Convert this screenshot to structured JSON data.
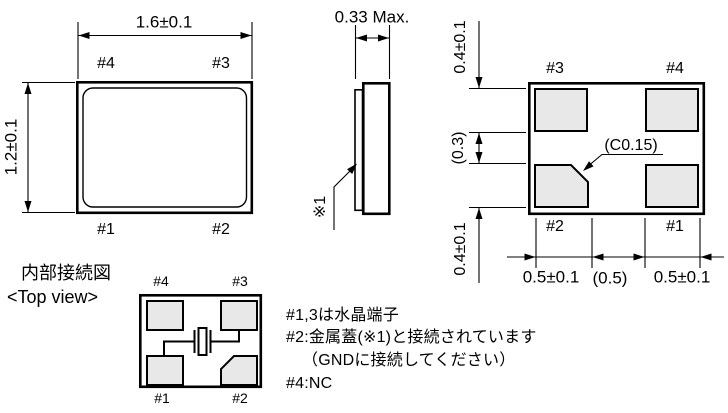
{
  "top_view": {
    "dim_width": "1.6±0.1",
    "dim_height": "1.2±0.1",
    "pad4": "#4",
    "pad3": "#3",
    "pad1": "#1",
    "pad2": "#2"
  },
  "side_view": {
    "dim_thickness": "0.33 Max.",
    "lid_note_ref": "※1"
  },
  "land_pattern": {
    "pad3": "#3",
    "pad4": "#4",
    "pad2": "#2",
    "pad1": "#1",
    "chamfer_label": "(C0.15)",
    "dim_pad_top": "0.4±0.1",
    "dim_gap_v": "(0.3)",
    "dim_pad_bottom": "0.4±0.1",
    "dim_pad_left": "0.5±0.1",
    "dim_gap_h": "(0.5)",
    "dim_pad_right": "0.5±0.1"
  },
  "internal_diagram": {
    "title": "内部接続図",
    "subtitle": "<Top view>",
    "pad4": "#4",
    "pad3": "#3",
    "pad1": "#1",
    "pad2": "#2"
  },
  "notes": {
    "line1": "#1,3は水晶端子",
    "line2": "#2:金属蓋(※1)と接続されています",
    "line3": "（GNDに接続してください）",
    "line4": "#4:NC"
  },
  "colors": {
    "line": "#000000",
    "pad_fill": "#e8e8e8",
    "background": "#ffffff"
  }
}
